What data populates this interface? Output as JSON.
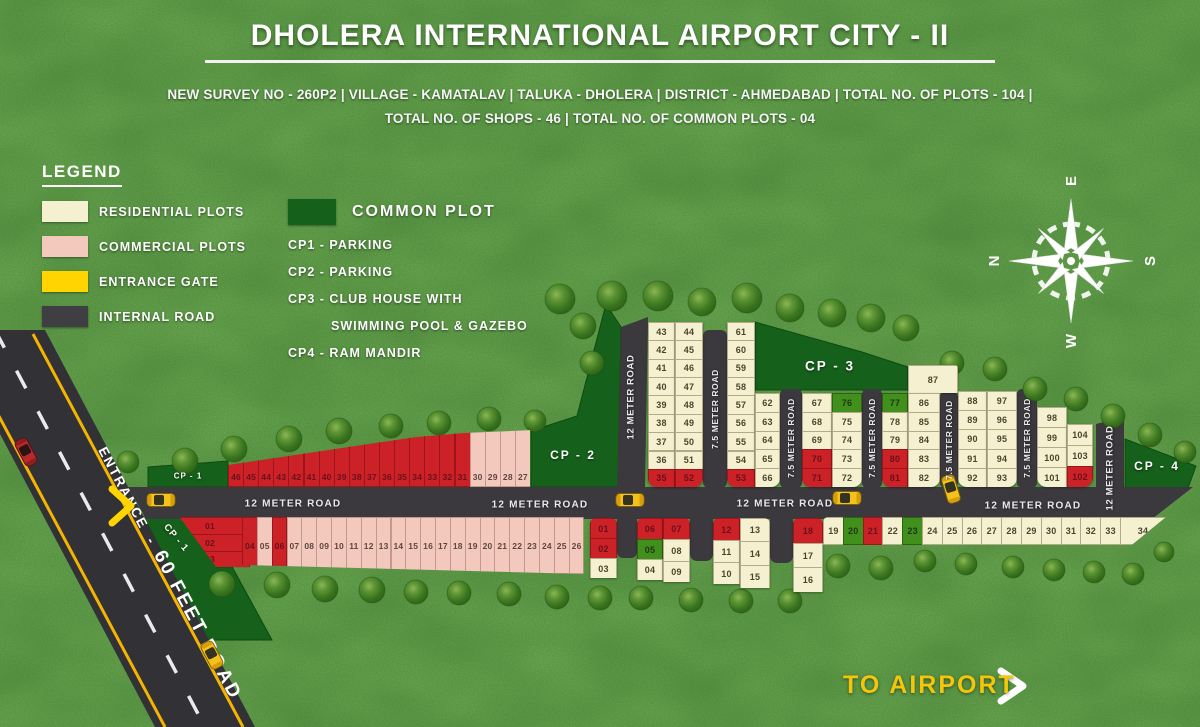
{
  "header": {
    "title": "DHOLERA INTERNATIONAL AIRPORT CITY - II",
    "subtitle_line1": "NEW SURVEY NO - 260P2 | VILLAGE - KAMATALAV | TALUKA - DHOLERA  | DISTRICT - AHMEDABAD | TOTAL NO. OF  PLOTS - 104 |",
    "subtitle_line2": "TOTAL NO. OF  SHOPS - 46 | TOTAL NO. OF COMMON PLOTS - 04"
  },
  "legend": {
    "title": "LEGEND",
    "items": [
      {
        "label": "RESIDENTIAL PLOTS",
        "color": "#f5f0cf"
      },
      {
        "label": "COMMERCIAL PLOTS",
        "color": "#f3c8bd"
      },
      {
        "label": "ENTRANCE GATE",
        "color": "#ffd401"
      },
      {
        "label": "INTERNAL ROAD",
        "color": "#3f3e42"
      }
    ],
    "common_plot": {
      "label": "COMMON PLOT",
      "color": "#15601a",
      "notes": [
        "CP1 - PARKING",
        "CP2 - PARKING",
        "CP3 - CLUB HOUSE WITH",
        "SWIMMING POOL & GAZEBO",
        "CP4 - RAM MANDIR"
      ]
    }
  },
  "compass": {
    "n": "N",
    "e": "E",
    "s": "S",
    "w": "W"
  },
  "roads": {
    "twelve_meter": "12 METER ROAD",
    "seven_half_meter": "7.5 METER ROAD",
    "entrance": "ENTRANCE",
    "separator": "-",
    "sixty_feet": "60 FEET ROAD"
  },
  "common_plots": {
    "cp1": "CP - 1",
    "cp2": "CP - 2",
    "cp3": "CP - 3",
    "cp4": "CP - 4"
  },
  "airport": {
    "label": "TO AIRPORT"
  },
  "palette": {
    "residential": "#f5f0cf",
    "commercial_pink": "#f3c8bd",
    "commercial_red": "#cc2227",
    "highlight_green": "#41901e",
    "common_plot_green": "#15601a",
    "road": "#3b393d",
    "entrance_yellow": "#ffd401",
    "grass": "#3d7a21"
  },
  "plots": {
    "groups": [
      {
        "id": "colA",
        "kind": "plots",
        "cells": [
          {
            "n": "43",
            "t": "c"
          },
          {
            "n": "42",
            "t": "c"
          },
          {
            "n": "41",
            "t": "c"
          },
          {
            "n": "40",
            "t": "c"
          },
          {
            "n": "39",
            "t": "c"
          },
          {
            "n": "38",
            "t": "c"
          },
          {
            "n": "37",
            "t": "c"
          },
          {
            "n": "36",
            "t": "c"
          },
          {
            "n": "35",
            "t": "r"
          }
        ]
      },
      {
        "id": "colB",
        "kind": "plots",
        "cells": [
          {
            "n": "44",
            "t": "c"
          },
          {
            "n": "45",
            "t": "c"
          },
          {
            "n": "46",
            "t": "c"
          },
          {
            "n": "47",
            "t": "c"
          },
          {
            "n": "48",
            "t": "c"
          },
          {
            "n": "49",
            "t": "c"
          },
          {
            "n": "50",
            "t": "c"
          },
          {
            "n": "51",
            "t": "c"
          },
          {
            "n": "52",
            "t": "r"
          }
        ]
      },
      {
        "id": "colC",
        "kind": "plots",
        "cells": [
          {
            "n": "61",
            "t": "c"
          },
          {
            "n": "60",
            "t": "c"
          },
          {
            "n": "59",
            "t": "c"
          },
          {
            "n": "58",
            "t": "c"
          },
          {
            "n": "57",
            "t": "c"
          },
          {
            "n": "56",
            "t": "c"
          },
          {
            "n": "55",
            "t": "c"
          },
          {
            "n": "54",
            "t": "c"
          },
          {
            "n": "53",
            "t": "r"
          }
        ]
      },
      {
        "id": "colD",
        "kind": "plots",
        "cells": [
          {
            "n": "62",
            "t": "c"
          },
          {
            "n": "63",
            "t": "c"
          },
          {
            "n": "64",
            "t": "c"
          },
          {
            "n": "65",
            "t": "c"
          },
          {
            "n": "66",
            "t": "c"
          }
        ]
      },
      {
        "id": "colE",
        "kind": "plots",
        "cells": [
          {
            "n": "67",
            "t": "c"
          },
          {
            "n": "68",
            "t": "c"
          },
          {
            "n": "69",
            "t": "c"
          },
          {
            "n": "70",
            "t": "r"
          },
          {
            "n": "71",
            "t": "r"
          }
        ]
      },
      {
        "id": "colF",
        "kind": "plots",
        "cells": [
          {
            "n": "76",
            "t": "g"
          },
          {
            "n": "75",
            "t": "c"
          },
          {
            "n": "74",
            "t": "c"
          },
          {
            "n": "73",
            "t": "c"
          },
          {
            "n": "72",
            "t": "c"
          }
        ]
      },
      {
        "id": "colG",
        "kind": "plots",
        "cells": [
          {
            "n": "77",
            "t": "g"
          },
          {
            "n": "78",
            "t": "c"
          },
          {
            "n": "79",
            "t": "c"
          },
          {
            "n": "80",
            "t": "r"
          },
          {
            "n": "81",
            "t": "r"
          }
        ]
      },
      {
        "id": "p87",
        "kind": "plots",
        "cells": [
          {
            "n": "87",
            "t": "c"
          }
        ]
      },
      {
        "id": "colH",
        "kind": "plots",
        "cells": [
          {
            "n": "86",
            "t": "c"
          },
          {
            "n": "85",
            "t": "c"
          },
          {
            "n": "84",
            "t": "c"
          },
          {
            "n": "83",
            "t": "c"
          },
          {
            "n": "82",
            "t": "c"
          }
        ]
      },
      {
        "id": "colI",
        "kind": "plots",
        "cells": [
          {
            "n": "88",
            "t": "c"
          },
          {
            "n": "89",
            "t": "c"
          },
          {
            "n": "90",
            "t": "c"
          },
          {
            "n": "91",
            "t": "c"
          },
          {
            "n": "92",
            "t": "c"
          }
        ]
      },
      {
        "id": "colJ",
        "kind": "plots",
        "cells": [
          {
            "n": "97",
            "t": "c"
          },
          {
            "n": "96",
            "t": "c"
          },
          {
            "n": "95",
            "t": "c"
          },
          {
            "n": "94",
            "t": "c"
          },
          {
            "n": "93",
            "t": "c"
          }
        ]
      },
      {
        "id": "colK",
        "kind": "plots",
        "cells": [
          {
            "n": "98",
            "t": "c"
          },
          {
            "n": "99",
            "t": "c"
          },
          {
            "n": "100",
            "t": "c"
          },
          {
            "n": "101",
            "t": "c"
          }
        ]
      },
      {
        "id": "colL",
        "kind": "plots",
        "cells": [
          {
            "n": "104",
            "t": "c"
          },
          {
            "n": "103",
            "t": "c"
          },
          {
            "n": "102",
            "t": "r"
          }
        ]
      },
      {
        "id": "shopsTop",
        "kind": "shops",
        "cells": [
          {
            "n": "46",
            "t": "r"
          },
          {
            "n": "45",
            "t": "r"
          },
          {
            "n": "44",
            "t": "r"
          },
          {
            "n": "43",
            "t": "r"
          },
          {
            "n": "42",
            "t": "r"
          },
          {
            "n": "41",
            "t": "r"
          },
          {
            "n": "40",
            "t": "r"
          },
          {
            "n": "39",
            "t": "r"
          },
          {
            "n": "38",
            "t": "r"
          },
          {
            "n": "37",
            "t": "r"
          },
          {
            "n": "36",
            "t": "r"
          },
          {
            "n": "35",
            "t": "r"
          },
          {
            "n": "34",
            "t": "r"
          },
          {
            "n": "33",
            "t": "r"
          },
          {
            "n": "32",
            "t": "r"
          },
          {
            "n": "31",
            "t": "r"
          },
          {
            "n": "30",
            "t": "p"
          },
          {
            "n": "29",
            "t": "p"
          },
          {
            "n": "28",
            "t": "p"
          },
          {
            "n": "27",
            "t": "p"
          }
        ]
      },
      {
        "id": "shopsLeft",
        "kind": "shops",
        "cells": [
          {
            "n": "01",
            "t": "r"
          },
          {
            "n": "02",
            "t": "r"
          },
          {
            "n": "03",
            "t": "r"
          }
        ]
      },
      {
        "id": "shopsBottom",
        "kind": "shops",
        "cells": [
          {
            "n": "04",
            "t": "r"
          },
          {
            "n": "05",
            "t": "p"
          },
          {
            "n": "06",
            "t": "r"
          },
          {
            "n": "07",
            "t": "p"
          },
          {
            "n": "08",
            "t": "p"
          },
          {
            "n": "09",
            "t": "p"
          },
          {
            "n": "10",
            "t": "p"
          },
          {
            "n": "11",
            "t": "p"
          },
          {
            "n": "12",
            "t": "p"
          },
          {
            "n": "13",
            "t": "p"
          },
          {
            "n": "14",
            "t": "p"
          },
          {
            "n": "15",
            "t": "p"
          },
          {
            "n": "16",
            "t": "p"
          },
          {
            "n": "17",
            "t": "p"
          },
          {
            "n": "18",
            "t": "p"
          },
          {
            "n": "19",
            "t": "p"
          },
          {
            "n": "20",
            "t": "p"
          },
          {
            "n": "21",
            "t": "p"
          },
          {
            "n": "22",
            "t": "p"
          },
          {
            "n": "23",
            "t": "p"
          },
          {
            "n": "24",
            "t": "p"
          },
          {
            "n": "25",
            "t": "p"
          },
          {
            "n": "26",
            "t": "p"
          }
        ]
      },
      {
        "id": "b1",
        "kind": "plots",
        "cells": [
          {
            "n": "01",
            "t": "r"
          },
          {
            "n": "02",
            "t": "r"
          },
          {
            "n": "03",
            "t": "c"
          }
        ]
      },
      {
        "id": "b2a",
        "kind": "plots",
        "cells": [
          {
            "n": "06",
            "t": "r"
          },
          {
            "n": "05",
            "t": "g"
          },
          {
            "n": "04",
            "t": "c"
          }
        ]
      },
      {
        "id": "b2b",
        "kind": "plots",
        "cells": [
          {
            "n": "07",
            "t": "r"
          },
          {
            "n": "08",
            "t": "c"
          },
          {
            "n": "09",
            "t": "c"
          }
        ]
      },
      {
        "id": "b3a",
        "kind": "plots",
        "cells": [
          {
            "n": "12",
            "t": "r"
          },
          {
            "n": "11",
            "t": "c"
          },
          {
            "n": "10",
            "t": "c"
          }
        ]
      },
      {
        "id": "b3b",
        "kind": "plots",
        "cells": [
          {
            "n": "13",
            "t": "c"
          },
          {
            "n": "14",
            "t": "c"
          },
          {
            "n": "15",
            "t": "c"
          }
        ]
      },
      {
        "id": "b4",
        "kind": "plots",
        "cells": [
          {
            "n": "18",
            "t": "r"
          },
          {
            "n": "17",
            "t": "c"
          },
          {
            "n": "16",
            "t": "c"
          }
        ]
      },
      {
        "id": "row19",
        "kind": "plots",
        "cells": [
          {
            "n": "19",
            "t": "c"
          },
          {
            "n": "20",
            "t": "g"
          },
          {
            "n": "21",
            "t": "r"
          },
          {
            "n": "22",
            "t": "c"
          },
          {
            "n": "23",
            "t": "g"
          },
          {
            "n": "24",
            "t": "c"
          },
          {
            "n": "25",
            "t": "c"
          },
          {
            "n": "26",
            "t": "c"
          },
          {
            "n": "27",
            "t": "c"
          },
          {
            "n": "28",
            "t": "c"
          },
          {
            "n": "29",
            "t": "c"
          },
          {
            "n": "30",
            "t": "c"
          },
          {
            "n": "31",
            "t": "c"
          },
          {
            "n": "32",
            "t": "c"
          },
          {
            "n": "33",
            "t": "c"
          },
          {
            "n": "34",
            "t": "c"
          }
        ]
      }
    ]
  }
}
